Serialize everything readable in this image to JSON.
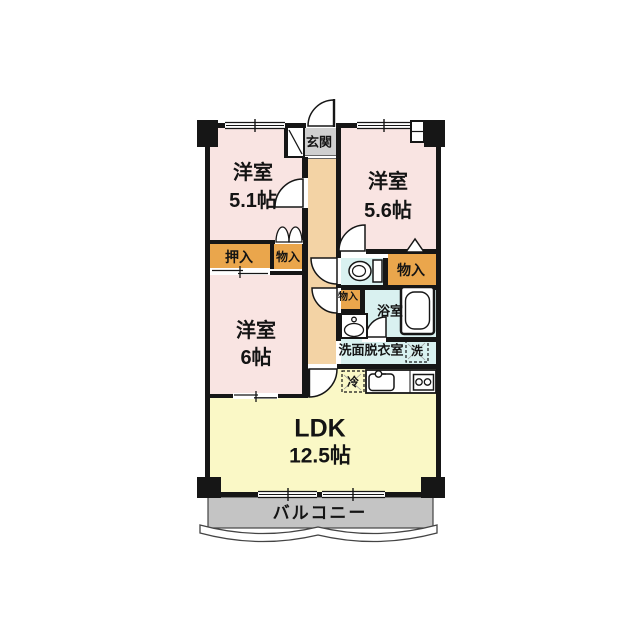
{
  "rooms": [
    {
      "name": "洋室",
      "size": "5.1帖"
    },
    {
      "name": "洋室",
      "size": "5.6帖"
    },
    {
      "name": "洋室",
      "size": "6帖"
    },
    {
      "name": "LDK",
      "size": "12.5帖"
    }
  ],
  "labels": {
    "genkan": "玄関",
    "oshiire": "押入",
    "monoire": "物入",
    "bath": "浴室",
    "washroom": "洗面脱衣室",
    "laundry": "洗",
    "fridge": "冷",
    "balcony": "バルコニー"
  },
  "colors": {
    "room_pink": "#F9E4E2",
    "closet_orange": "#EAA64C",
    "hall_beige": "#F3D3A5",
    "wet_blue": "#D9F1F0",
    "ldk_yellow": "#FAF8C6",
    "balcony_gray": "#C4C4C4",
    "genkan_gray": "#CFCFCF",
    "wall_black": "#161616"
  }
}
